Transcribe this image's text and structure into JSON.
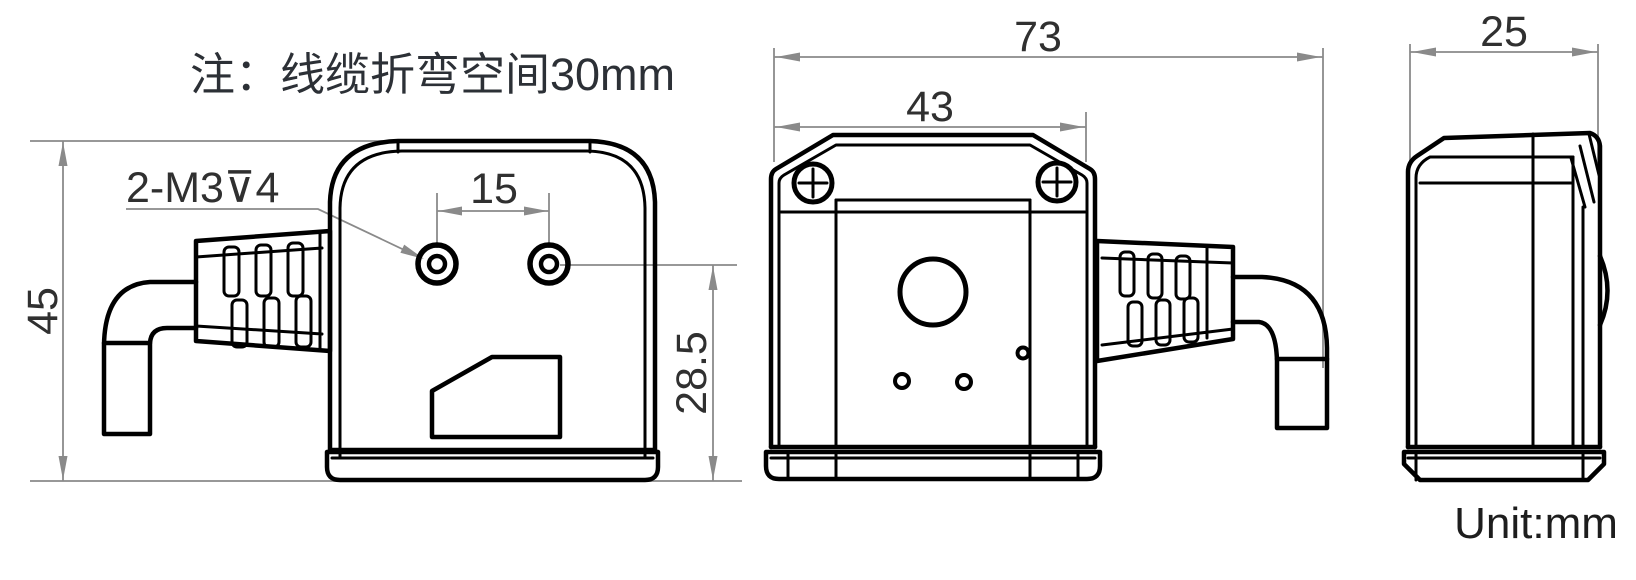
{
  "drawing": {
    "note": "注：线缆折弯空间30mm",
    "unit": "Unit:mm",
    "colors": {
      "outline": "#000000",
      "dimension_line": "#8a8a8a",
      "label_text": "#303030"
    },
    "left_view": {
      "thread_callout": "2-M3⊽4",
      "height": "45",
      "hole_spacing": "15",
      "hole_to_base": "28.5"
    },
    "front_view": {
      "overall_width": "73",
      "body_width": "43"
    },
    "side_view": {
      "depth": "25"
    }
  }
}
